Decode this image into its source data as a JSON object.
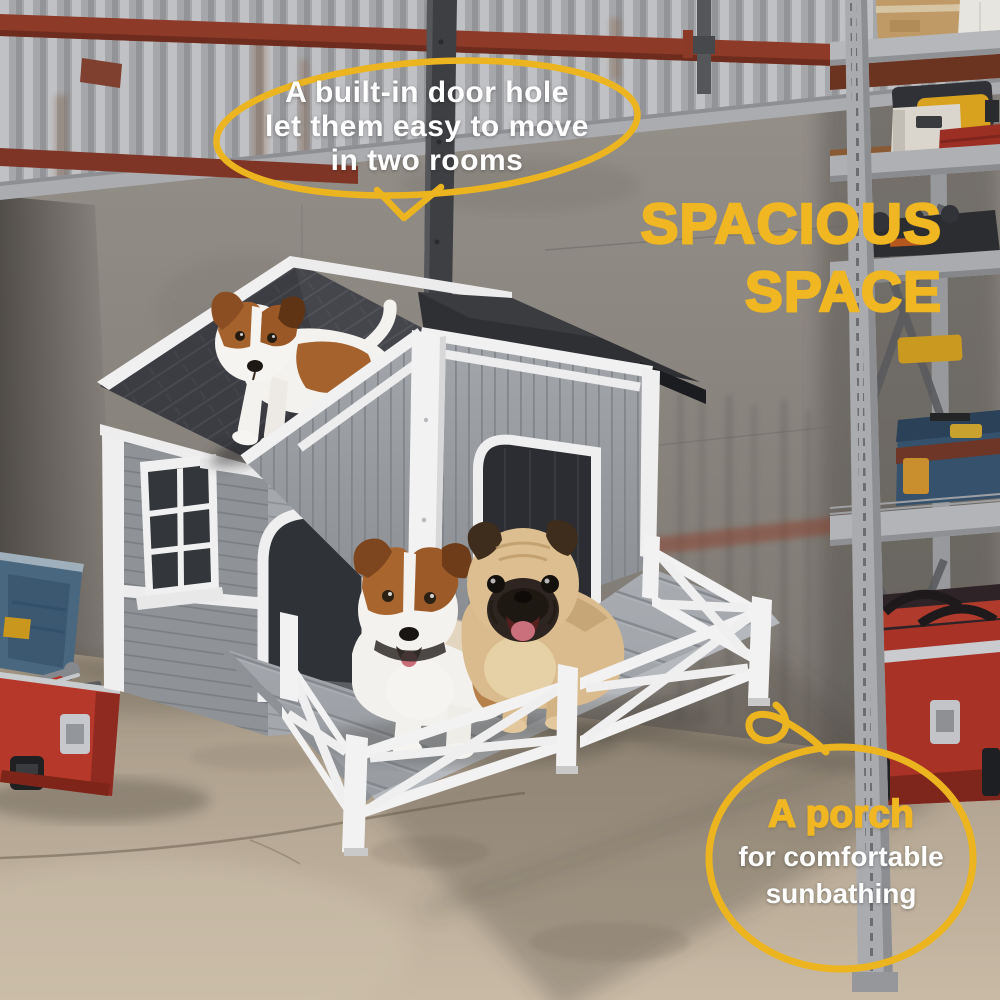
{
  "image_type": "product lifestyle marketing photo",
  "colors": {
    "accent_yellow": "#F0B722",
    "bubble_outline": "#ECB51F",
    "callout_text": "#FFFFFF"
  },
  "callout_door": {
    "lines": [
      "A built-in door hole",
      "let them easy to move",
      "in two rooms"
    ]
  },
  "headline": {
    "lines": [
      "SPACIOUS",
      "SPACE"
    ]
  },
  "callout_porch": {
    "title": "A porch",
    "lines": [
      "for comfortable",
      "sunbathing"
    ]
  },
  "scene": {
    "setting": "garage interior with corrugated metal and concrete walls",
    "objects": [
      "two-room wooden dog house with porch",
      "puppy on roof",
      "jack russell dog on porch",
      "pug dog on porch",
      "open red toolbox",
      "metal storage rack with boxes and tools",
      "red rolling tool chest",
      "blue toolbox"
    ]
  }
}
